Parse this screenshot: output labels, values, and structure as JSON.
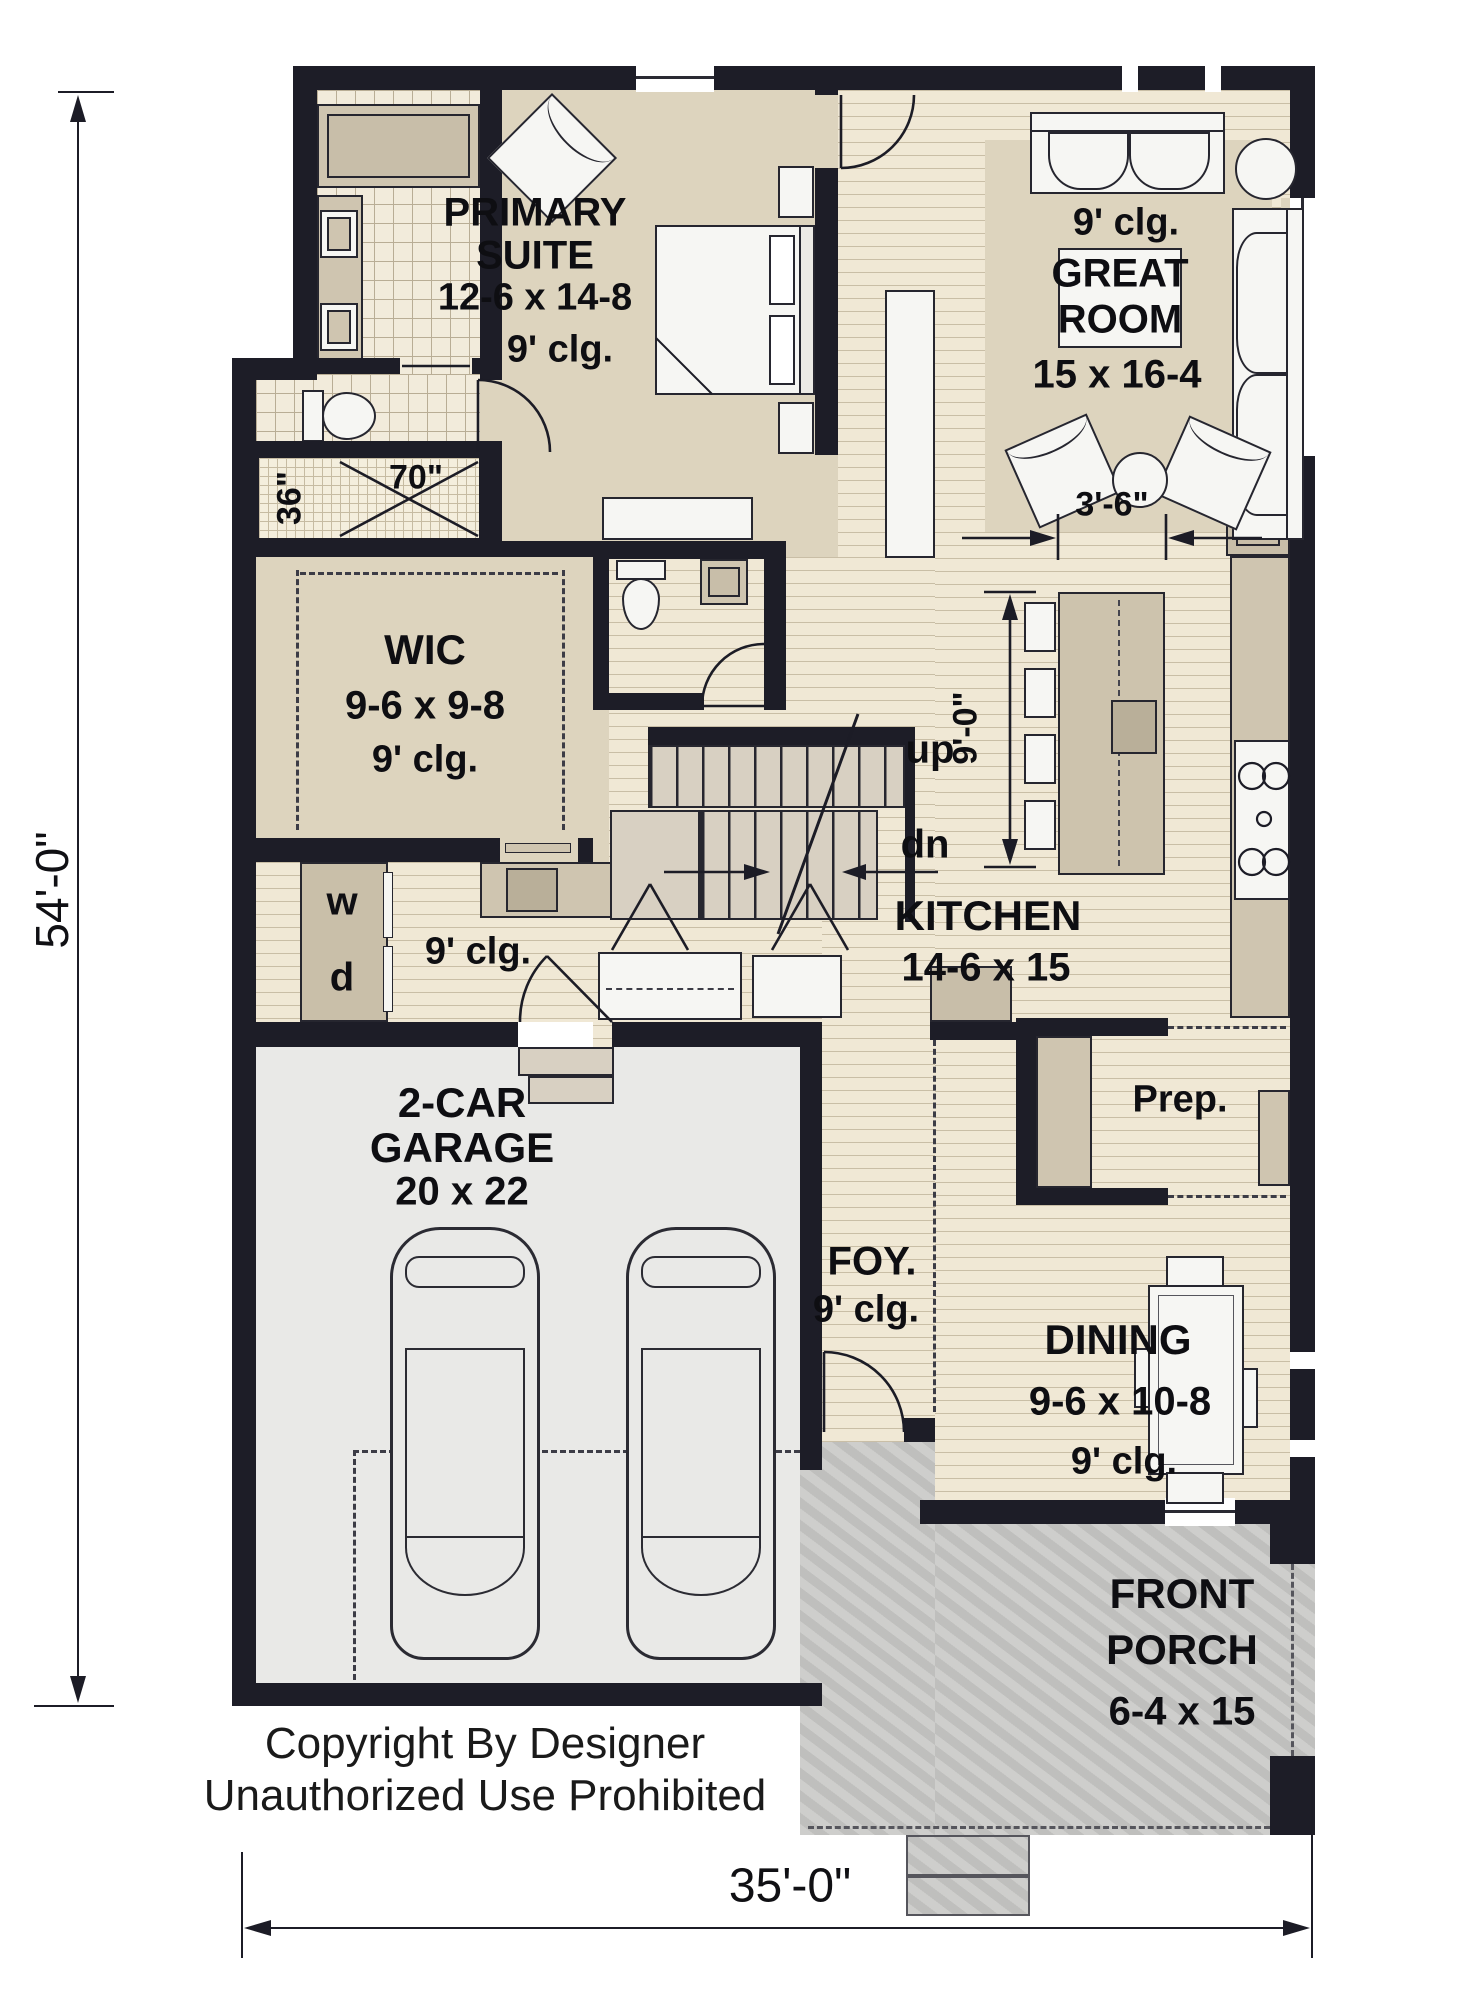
{
  "copyright": {
    "line1": "Copyright By Designer",
    "line2": "Unauthorized Use Prohibited"
  },
  "dims": {
    "overall_h": "54'-0\"",
    "overall_w": "35'-0\"",
    "island_clear": "3'-6\"",
    "island_len": "9'-0\"",
    "shower_w": "36\"",
    "shower_l": "70\""
  },
  "rooms": {
    "primary": {
      "l1": "PRIMARY",
      "l2": "SUITE",
      "size": "12-6 x 14-8",
      "clg": "9' clg."
    },
    "great": {
      "l1": "GREAT",
      "l2": "ROOM",
      "clg": "9' clg.",
      "size": "15 x 16-4"
    },
    "wic": {
      "name": "WIC",
      "size": "9-6 x 9-8",
      "clg": "9' clg."
    },
    "kitchen": {
      "name": "KITCHEN",
      "size": "14-6 x 15"
    },
    "prep": {
      "name": "Prep."
    },
    "foyer": {
      "name": "FOY.",
      "clg": "9' clg."
    },
    "dining": {
      "name": "DINING",
      "size": "9-6 x 10-8",
      "clg": "9' clg."
    },
    "porch": {
      "l1": "FRONT",
      "l2": "PORCH",
      "size": "6-4 x 15"
    },
    "garage": {
      "l1": "2-CAR",
      "l2": "GARAGE",
      "size": "20 x 22"
    },
    "hall": {
      "clg": "9' clg."
    }
  },
  "stairs": {
    "up": "up",
    "dn": "dn"
  },
  "laundry": {
    "w": "w",
    "d": "d"
  },
  "colors": {
    "wall": "#1d1d27",
    "floor_tan": "#ddd4be",
    "wood": "#f0e8d5",
    "garage": "#e9e9e7",
    "porch": "#c7c7c5"
  }
}
